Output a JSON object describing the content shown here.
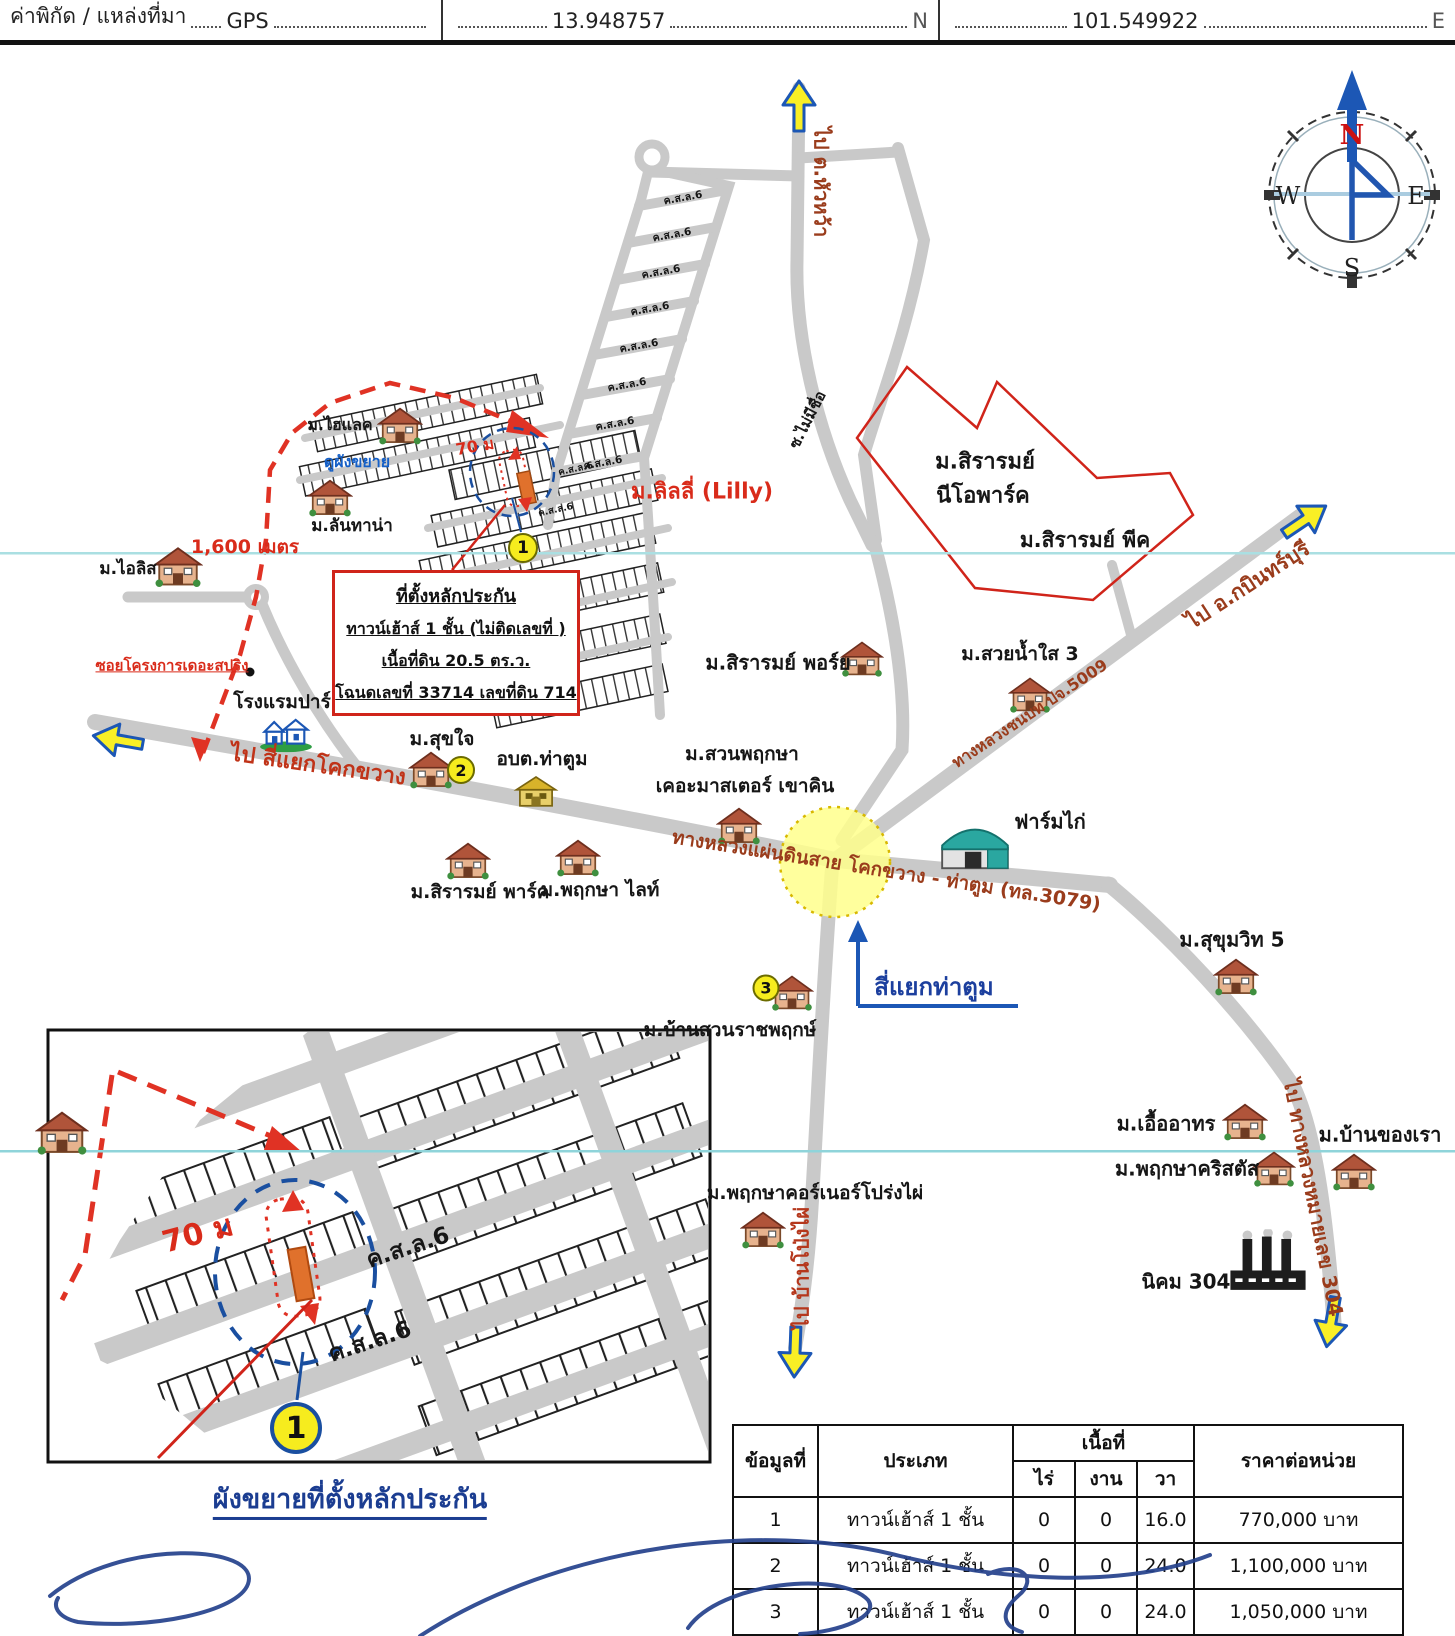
{
  "header": {
    "label": "ค่าพิกัด / แหล่งที่มา",
    "source": "GPS",
    "latitude": "13.948757",
    "lat_dir": "N",
    "longitude": "101.549922",
    "lon_dir": "E"
  },
  "compass": {
    "north": "N",
    "east": "E",
    "south": "S",
    "west": "W"
  },
  "callout": {
    "title": "ที่ตั้งหลักประกัน",
    "line2": "ทาวน์เฮ้าส์ 1 ชั้น (ไม่ติดเลขที่ )",
    "line3": "เนื้อที่ดิน 20.5 ตร.ว.",
    "line4": "โฉนดเลขที่ 33714 เลขที่ดิน 714"
  },
  "badges": {
    "b1": "1",
    "b2": "2",
    "b3": "3"
  },
  "roads": {
    "to_huawa": "ไป ต.หัวหว้า",
    "soi_no_name": "ซ.ไม่มีชื่อ",
    "to_kabinburi": "ไป อ.กบินทร์บุรี",
    "rural_5009": "ทางหลวงชนบท ปจ.5009",
    "to_khokkwang": "ไป สี่แยกโคกขวาง",
    "highway_3079": "ทางหลวงแผ่นดินสาย โคกขวาง - ท่าตูม (ทล.3079)",
    "to_pongphai": "ไป บ้านโป่งไผ่",
    "to_304": "ไป ทางหลวงหมายเลข 304",
    "soi_thespring": "ซอยโครงการเดอะสปริง",
    "csl6": "ค.ส.ล.6"
  },
  "places": {
    "sirarom_neo1": "ม.สิรารมย์",
    "sirarom_neo2": "นีโอพาร์ค",
    "sirarom_peak": "ม.สิรารมย์ พีค",
    "suay_nam_sai": "ม.สวยน้ำใส 3",
    "sirarom_porch": "ม.สิรารมย์ พอร์ย",
    "lilly": "ม.ลิลลี่ (Lilly)",
    "hilake": "ม.ไฮแลค",
    "see_enlarged": "ดูผังขยาย",
    "lantana": "ม.ลันทาน่า",
    "iris": "ม.ไอลิส",
    "distance_1600": "1,600 เมตร",
    "park_hotel": "โรงแรมปาร์",
    "sukjai": "ม.สุขใจ",
    "obt_thatum": "อบต.ท่าตูม",
    "suanpruksa1": "ม.สวนพฤกษา",
    "suanpruksa2": "เคอะมาสเตอร์ เขาคิน",
    "sirarom_park": "ม.สิรารมย์ พาร์ค",
    "pruksa_light": "ม.พฤกษา ไลท์",
    "chicken_farm": "ฟาร์มไก่",
    "thatum_intersection": "สี่แยกท่าตูม",
    "baansuan_ratchaphruek": "ม.บ้านสวนราชพฤกษ์",
    "sukhumvit5": "ม.สุขุมวิท 5",
    "uea_athon": "ม.เอื้ออาทร",
    "baan_khong_rao": "ม.บ้านของเรา",
    "pruksa_cristal": "ม.พฤกษาคริสตัส",
    "nikhom_304": "นิคม 304",
    "pruksa_corner": "ม.พฤกษาคอร์เนอร์โปร่งไผ่",
    "dist_70m": "70 ม"
  },
  "inset": {
    "dist_70m": "70 ม",
    "csl6_a": "ค.ส.ล.6",
    "csl6_b": "ค.ส.ล.6",
    "badge": "1",
    "caption": "ผังขยายที่ตั้งหลักประกัน"
  },
  "table": {
    "col_no": "ข้อมูลที่",
    "col_type": "ประเภท",
    "col_area": "เนื้อที่",
    "col_rai": "ไร่",
    "col_ngan": "งาน",
    "col_wa": "วา",
    "col_price": "ราคาต่อหน่วย",
    "rows": [
      {
        "no": "1",
        "type": "ทาวน์เฮ้าส์ 1 ชั้น",
        "rai": "0",
        "ngan": "0",
        "wa": "16.0",
        "price": "770,000 บาท"
      },
      {
        "no": "2",
        "type": "ทาวน์เฮ้าส์ 1 ชั้น",
        "rai": "0",
        "ngan": "0",
        "wa": "24.0",
        "price": "1,100,000 บาท"
      },
      {
        "no": "3",
        "type": "ทาวน์เฮ้าส์ 1 ชั้น",
        "rai": "0",
        "ngan": "0",
        "wa": "24.0",
        "price": "1,050,000 บาท"
      }
    ]
  },
  "colors": {
    "road_gray": "#c9c9c9",
    "route_red": "#e03224",
    "label_dark_red": "#9a3c1c",
    "blue": "#1c57b5",
    "badge_yellow": "#f6ec1e",
    "highlight_yellow": "#ffffa0"
  }
}
